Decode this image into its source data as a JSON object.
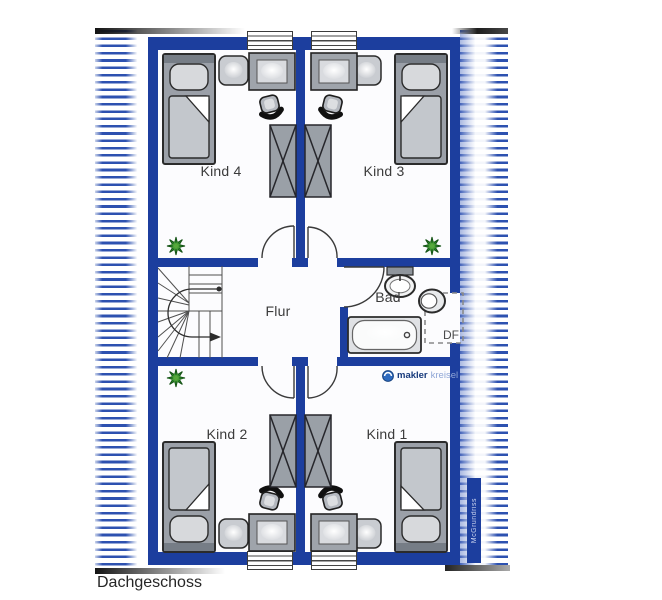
{
  "floor_title": "Dachgeschoss",
  "rooms": {
    "kind4": {
      "label": "Kind 4"
    },
    "kind3": {
      "label": "Kind 3"
    },
    "kind2": {
      "label": "Kind 2"
    },
    "kind1": {
      "label": "Kind 1"
    },
    "flur": {
      "label": "Flur"
    },
    "bad": {
      "label": "Bad"
    }
  },
  "annotations": {
    "roof_window": "DF"
  },
  "branding": {
    "logo_bold": "makler",
    "logo_light": "kreisel",
    "watermark": "McGrundriss"
  },
  "colors": {
    "wall": "#1c3e9e",
    "hatch": "#2d51b0",
    "logo-dark": "#173a7c",
    "logo-light": "#8fa6d6"
  }
}
